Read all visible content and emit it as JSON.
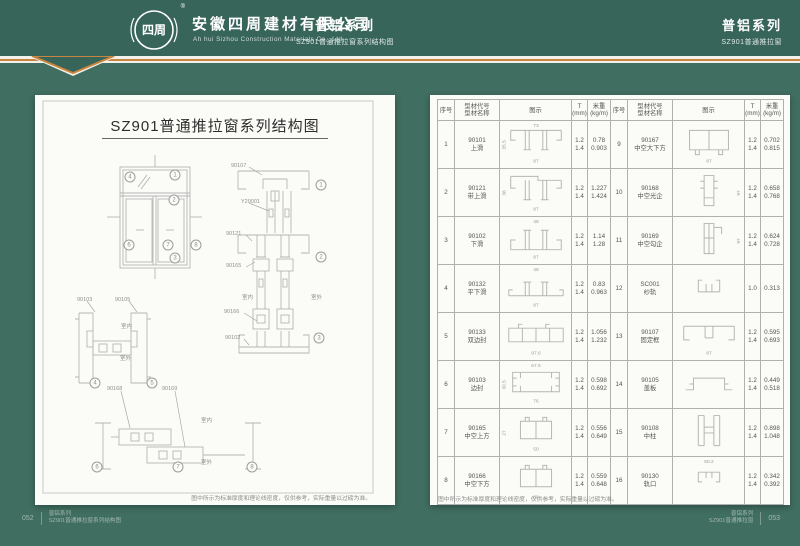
{
  "colors": {
    "header_green": "#38655a",
    "body_green": "#406e60",
    "accent_orange": "#c8853f",
    "page_bg": "#fbfbf8"
  },
  "header": {
    "logo_text": "四周",
    "registered_mark": "®",
    "company_cn": "安徽四周建材有限公司",
    "company_en": "Ah hui Sizhou Construction Materials Co., Ltd.",
    "center_series": "普铝系列",
    "center_sub": "SZ901普通推拉窗系列结构图",
    "right_series": "普铝系列",
    "right_sub": "SZ901普通推拉窗"
  },
  "left_page": {
    "title": "SZ901普通推拉窗系列结构图",
    "note": "图中所示为标准厚度和理论线密度，仅供参考，实际重量以过磅为准。",
    "labels": [
      {
        "t": "90107",
        "x": 196,
        "y": 68
      },
      {
        "t": "Y20001",
        "x": 206,
        "y": 104
      },
      {
        "t": "90121",
        "x": 191,
        "y": 136
      },
      {
        "t": "90165",
        "x": 191,
        "y": 168
      },
      {
        "t": "90166",
        "x": 189,
        "y": 214
      },
      {
        "t": "90102",
        "x": 190,
        "y": 240
      },
      {
        "t": "90103",
        "x": 42,
        "y": 202
      },
      {
        "t": "90105",
        "x": 80,
        "y": 202
      },
      {
        "t": "90168",
        "x": 72,
        "y": 291
      },
      {
        "t": "90169",
        "x": 127,
        "y": 291
      },
      {
        "t": "室内",
        "x": 207,
        "y": 200
      },
      {
        "t": "室外",
        "x": 276,
        "y": 200
      },
      {
        "t": "室内",
        "x": 86,
        "y": 229
      },
      {
        "t": "室外",
        "x": 85,
        "y": 261
      },
      {
        "t": "室内",
        "x": 166,
        "y": 323
      },
      {
        "t": "室外",
        "x": 166,
        "y": 365
      }
    ],
    "balloons": [
      {
        "n": "4",
        "x": 95,
        "y": 82
      },
      {
        "n": "1",
        "x": 140,
        "y": 80
      },
      {
        "n": "2",
        "x": 139,
        "y": 105
      },
      {
        "n": "6",
        "x": 94,
        "y": 150
      },
      {
        "n": "7",
        "x": 133,
        "y": 150
      },
      {
        "n": "8",
        "x": 161,
        "y": 150
      },
      {
        "n": "3",
        "x": 140,
        "y": 163
      },
      {
        "n": "1",
        "x": 286,
        "y": 90
      },
      {
        "n": "2",
        "x": 286,
        "y": 162
      },
      {
        "n": "3",
        "x": 284,
        "y": 243
      },
      {
        "n": "4",
        "x": 60,
        "y": 288
      },
      {
        "n": "5",
        "x": 117,
        "y": 288
      },
      {
        "n": "6",
        "x": 62,
        "y": 372
      },
      {
        "n": "7",
        "x": 143,
        "y": 372
      },
      {
        "n": "8",
        "x": 217,
        "y": 372
      }
    ]
  },
  "right_page": {
    "table": {
      "headers": {
        "no": "序号",
        "code": "型材代号\n型材名称",
        "diagram": "图示",
        "t": "T\n(mm)",
        "weight": "米重\n(kg/m)"
      },
      "rows": [
        {
          "no": "1",
          "code": "90101",
          "name": "上滑",
          "t": "1.2\n1.4",
          "w": "0.78\n0.903",
          "kind": "track-down",
          "dims": {
            "top": "73",
            "left": "35.5",
            "bottom": "87"
          }
        },
        {
          "no": "2",
          "code": "90121",
          "name": "带上滑",
          "t": "1.2\n1.4",
          "w": "1.227\n1.424",
          "kind": "track-down2",
          "dims": {
            "left": "38",
            "bottom": "87"
          }
        },
        {
          "no": "3",
          "code": "90102",
          "name": "下滑",
          "t": "1.2\n1.4",
          "w": "1.14\n1.28",
          "kind": "track-up",
          "dims": {
            "top": "48",
            "bottom": "87"
          }
        },
        {
          "no": "4",
          "code": "90132",
          "name": "平下滑",
          "t": "1.2\n1.4",
          "w": "0.83\n0.963",
          "kind": "flat",
          "dims": {
            "top": "48",
            "bottom": "87"
          }
        },
        {
          "no": "5",
          "code": "90133",
          "name": "双边封",
          "t": "1.2\n1.4",
          "w": "1.056\n1.232",
          "kind": "tube",
          "dims": {
            "bottom": "97.6"
          }
        },
        {
          "no": "6",
          "code": "90103",
          "name": "边封",
          "t": "1.2\n1.4",
          "w": "0.598\n0.692",
          "kind": "sideseal",
          "dims": {
            "top": "67.6",
            "left": "30.5",
            "bottom": "76"
          }
        },
        {
          "no": "7",
          "code": "90165",
          "name": "中空上方",
          "t": "1.2\n1.4",
          "w": "0.556\n0.649",
          "kind": "sash",
          "dims": {
            "left": "27",
            "bottom": "50"
          }
        },
        {
          "no": "8",
          "code": "90166",
          "name": "中空下方",
          "t": "1.2\n1.4",
          "w": "0.559\n0.648",
          "kind": "sash",
          "dims": {
            "bottom": "60"
          }
        },
        {
          "no": "9",
          "code": "90167",
          "name": "中空大下方",
          "t": "1.2\n1.4",
          "w": "0.702\n0.815",
          "kind": "sash9",
          "dims": {
            "bottom": "87"
          }
        },
        {
          "no": "10",
          "code": "90168",
          "name": "中空光企",
          "t": "1.2\n1.4",
          "w": "0.658\n0.768",
          "kind": "stile",
          "dims": {
            "right": "97"
          }
        },
        {
          "no": "11",
          "code": "90169",
          "name": "中空勾企",
          "t": "1.2\n1.4",
          "w": "0.624\n0.728",
          "kind": "stilehook",
          "dims": {
            "right": "97"
          }
        },
        {
          "no": "12",
          "code": "SC001",
          "name": "纱轨",
          "t": "1.0",
          "w": "0.313",
          "kind": "smallu",
          "dims": {}
        },
        {
          "no": "13",
          "code": "90107",
          "name": "固定框",
          "t": "1.2\n1.4",
          "w": "0.595\n0.693",
          "kind": "framec",
          "dims": {
            "bottom": "87"
          }
        },
        {
          "no": "14",
          "code": "90105",
          "name": "盖板",
          "t": "1.2\n1.4",
          "w": "0.449\n0.518",
          "kind": "hat",
          "dims": {}
        },
        {
          "no": "15",
          "code": "90108",
          "name": "中柱",
          "t": "1.2\n1.4",
          "w": "0.898\n1.048",
          "kind": "post",
          "dims": {}
        },
        {
          "no": "16",
          "code": "90130",
          "name": "轨口",
          "t": "1.2\n1.4",
          "w": "0.342\n0.392",
          "kind": "clip",
          "dims": {
            "top": "50.2"
          }
        }
      ]
    },
    "note": "图中所示为标准厚度和理论线密度，仅供参考，实际重量以过磅为准。"
  },
  "footer_left": {
    "page": "052",
    "series": "普铝系列",
    "sub": "SZ901普通推拉窗系列结构图"
  },
  "footer_right": {
    "series": "普铝系列",
    "sub": "SZ901普通推拉窗",
    "page": "053"
  }
}
